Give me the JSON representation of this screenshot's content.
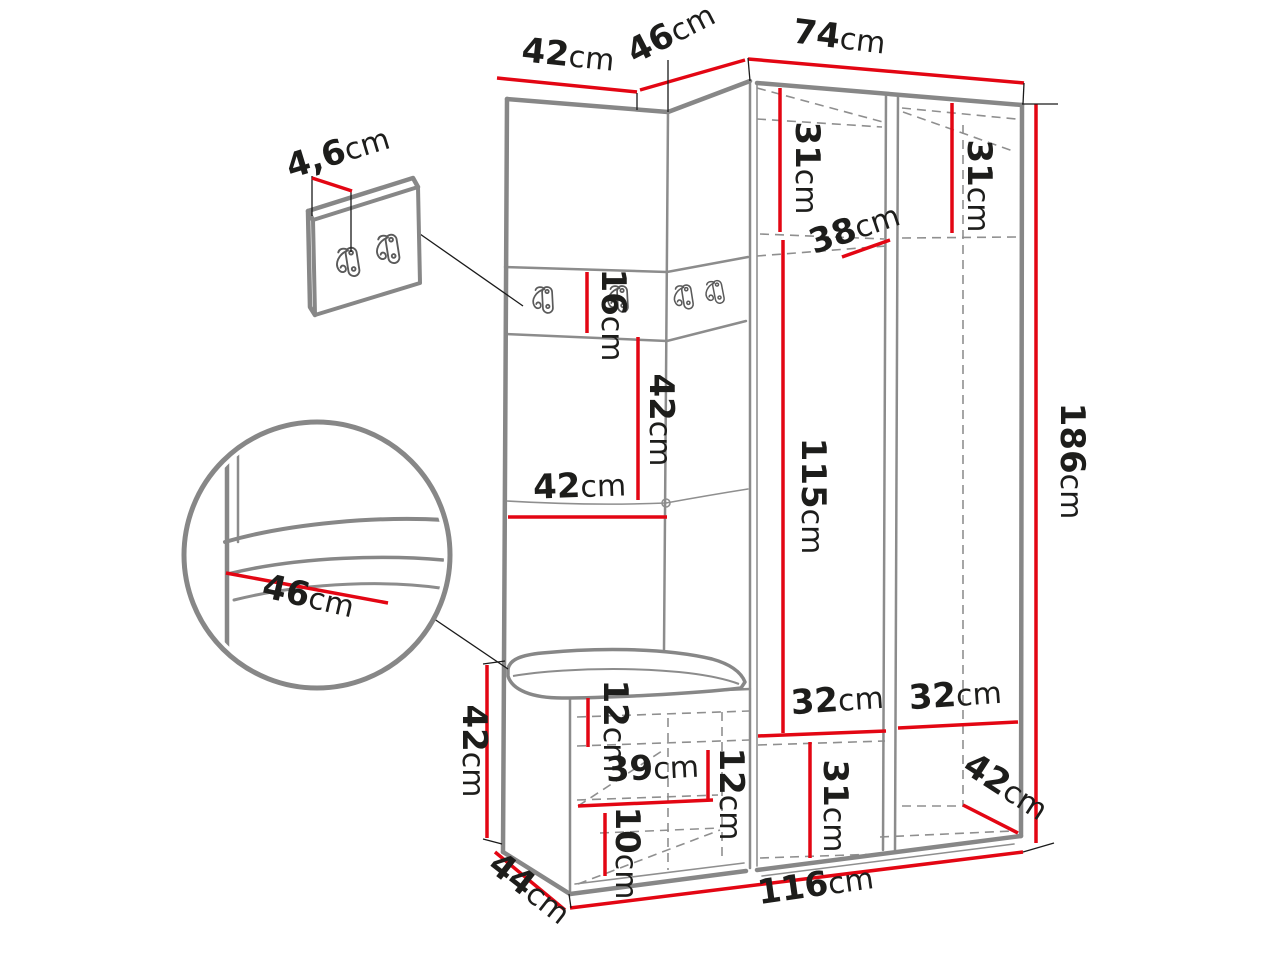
{
  "diagram": {
    "kind": "furniture-dimension-drawing",
    "unit": "cm",
    "dims": {
      "left_section_width": {
        "value": "42",
        "unit": "cm"
      },
      "corner_section_width": {
        "value": "46",
        "unit": "cm"
      },
      "wardrobe_width": {
        "value": "74",
        "unit": "cm"
      },
      "hook_board_thickness": {
        "value": "4,6",
        "unit": "cm"
      },
      "left_top_shelf_height": {
        "value": "31",
        "unit": "cm"
      },
      "right_top_shelf_height": {
        "value": "31",
        "unit": "cm"
      },
      "top_shelf_depth": {
        "value": "38",
        "unit": "cm"
      },
      "hook_strip_height": {
        "value": "16",
        "unit": "cm"
      },
      "back_panel_height": {
        "value": "42",
        "unit": "cm"
      },
      "back_panel_width": {
        "value": "42",
        "unit": "cm"
      },
      "hanging_space_height": {
        "value": "115",
        "unit": "cm"
      },
      "total_height": {
        "value": "186",
        "unit": "cm"
      },
      "seat_detail_depth": {
        "value": "46",
        "unit": "cm"
      },
      "bench_height": {
        "value": "42",
        "unit": "cm"
      },
      "bench_top_gap": {
        "value": "12",
        "unit": "cm"
      },
      "bench_inner_width": {
        "value": "39",
        "unit": "cm"
      },
      "bench_right_gap": {
        "value": "12",
        "unit": "cm"
      },
      "bench_bottom_gap": {
        "value": "10",
        "unit": "cm"
      },
      "left_bottom_shelf_width": {
        "value": "32",
        "unit": "cm"
      },
      "right_bottom_shelf_width": {
        "value": "32",
        "unit": "cm"
      },
      "bottom_shelf_height": {
        "value": "31",
        "unit": "cm"
      },
      "bottom_depth": {
        "value": "42",
        "unit": "cm"
      },
      "bench_depth": {
        "value": "44",
        "unit": "cm"
      },
      "total_width": {
        "value": "116",
        "unit": "cm"
      }
    }
  }
}
